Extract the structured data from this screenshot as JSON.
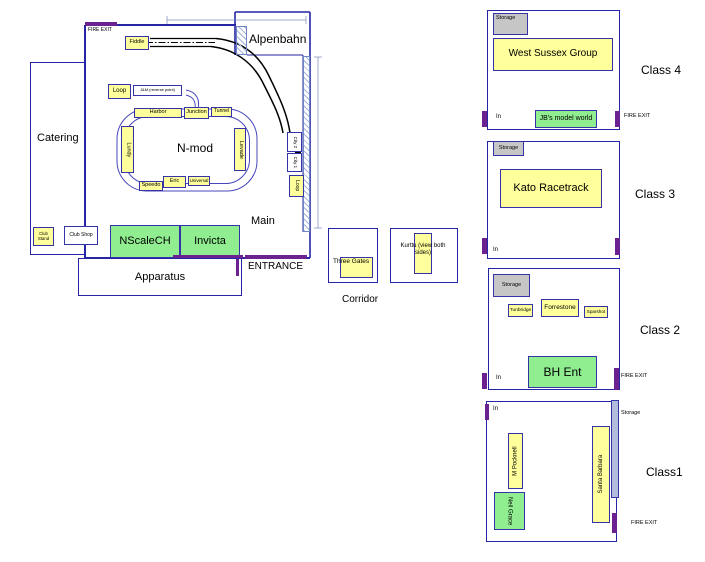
{
  "colors": {
    "wall_blue": "#2525a5",
    "box_border_blue": "#3434a8",
    "exhibit_yellow": "#ffff9b",
    "exhibit_green": "#90ee90",
    "storage_gray": "#c6c6c6",
    "storage_strip": "#b4bcdc",
    "fire_exit_purple": "#6b2190",
    "track_black": "#000000",
    "dimension_blue": "#8090c0"
  },
  "main_hall": {
    "fire_exit_top": "FIRE EXIT",
    "alpenbahn": "Alpenbahn",
    "catering": "Catering",
    "apparatus": "Apparatus",
    "entrance": "ENTRANCE",
    "main_area": "Main",
    "nmod": "N-mod",
    "fiddle": "Fiddle",
    "loop": "Loop",
    "loop_note": "J&M (reverse point)",
    "harbor": "Harbor",
    "junction": "Junction",
    "tunnel": "Tunnel",
    "lundy": "Lundy",
    "levade": "Levade",
    "speedo": "Speedo",
    "eric": "Eric",
    "universal": "Universal",
    "city2": "City 2",
    "city1": "City 1",
    "loop_right": "Loop",
    "club_stand": "Club Stand",
    "club_shop": "Club Shop",
    "nscalech": "NScaleCH",
    "invicta": "Invicta"
  },
  "corridor": {
    "label": "Corridor",
    "three_gates": "Three Gates",
    "kurttu": "Kurttu (view both sides)"
  },
  "class4": {
    "label": "Class 4",
    "storage": "Storage",
    "in": "In",
    "fire_exit": "FIRE EXIT",
    "west_sussex": "West Sussex Group",
    "jbs": "JB's model world"
  },
  "class3": {
    "label": "Class 3",
    "storage": "Storage",
    "in": "In",
    "kato": "Kato Racetrack"
  },
  "class2": {
    "label": "Class 2",
    "storage": "Storage",
    "in": "In",
    "fire_exit": "FIRE EXIT",
    "tunbridge": "Tunbridge",
    "forrestone": "Forrestone",
    "sparshot": "Sparshot",
    "bh_ent": "BH Ent"
  },
  "class1": {
    "label": "Class1",
    "storage": "Storage",
    "in": "In",
    "fire_exit": "FIRE EXIT",
    "m_pocknell": "M Pocknell",
    "neil_grace": "Neil Grace",
    "santa_barbara": "Santa Barbara"
  }
}
